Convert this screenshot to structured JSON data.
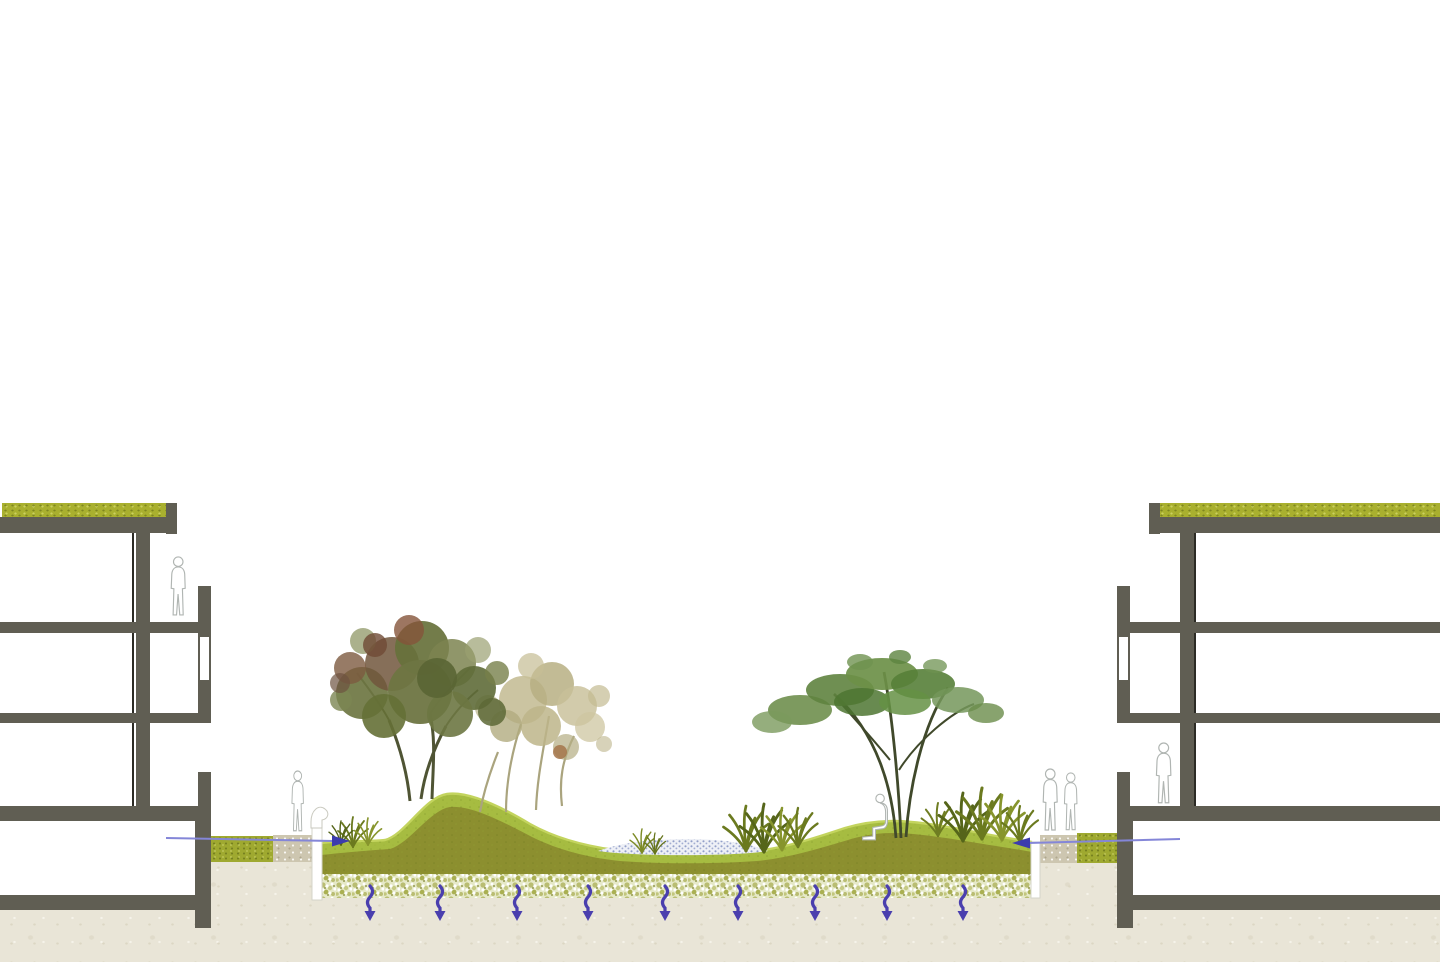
{
  "scene": {
    "kind": "landscape-architecture-section-diagram",
    "subject": "rain-garden swale between two residential building sections",
    "canvas": {
      "width": 1440,
      "height": 962,
      "background": "#ffffff"
    }
  },
  "palette": {
    "building_gray": "#605e53",
    "glazing_line": "#2c2b25",
    "green_roof": "#a9b02f",
    "lawn_green": "#a6bc41",
    "lawn_highlight": "#c3d45e",
    "subsoil_olive": "#8c8f2f",
    "gravel_base": "#e6e9c8",
    "gravel_speckle": "#aab052",
    "earth_beige": "#e9e5d7",
    "paving_tan": "#cdc6b0",
    "planting_strip_green": "#9fa930",
    "infiltration_arrow_indigo": "#4a3fae",
    "runoff_line_violet": "#8486d8",
    "runoff_arrowhead": "#3c3cae",
    "water_stipple_blue": "#93a0c9",
    "figure_outline": "#b0b5b2"
  },
  "buildings": {
    "left": {
      "floors_above_ground": 3,
      "basement": true,
      "green_roof": true,
      "occupant": "person standing on upper floor"
    },
    "right": {
      "floors_above_ground": 3,
      "basement": true,
      "green_roof": true,
      "occupant": "person standing at ground floor"
    }
  },
  "landscape": {
    "mounds": 2,
    "trees": [
      {
        "id": "left-front-tree",
        "foliage": "green with rust autumn patches",
        "stems": 3
      },
      {
        "id": "left-back-tree",
        "foliage": "pale tan, faded",
        "stems": 4
      },
      {
        "id": "right-tree",
        "foliage": "green umbrella canopy",
        "stems": 3
      }
    ],
    "grass_clumps": 6,
    "infiltration_basin_stipple": true,
    "section_layers_top_to_bottom": [
      "turf",
      "topsoil",
      "gravel drainage bed",
      "subsoil"
    ]
  },
  "water_flow": {
    "runoff_arrows": [
      {
        "from": "left building",
        "direction": "right"
      },
      {
        "from": "right building",
        "direction": "left"
      }
    ],
    "infiltration_arrows": {
      "count": 9,
      "direction": "down",
      "style": "wavy"
    }
  },
  "figures": {
    "count": 6,
    "style": "white outline silhouettes"
  }
}
